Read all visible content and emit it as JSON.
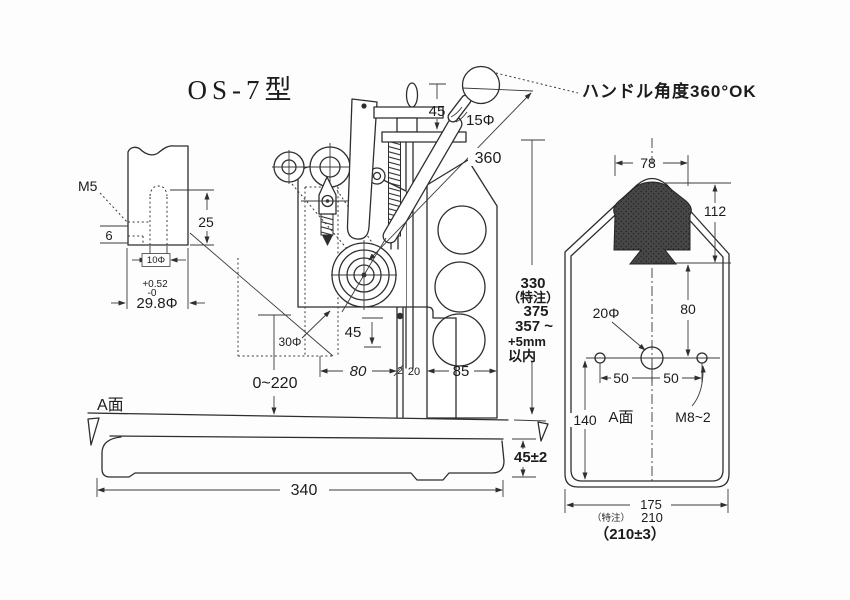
{
  "drawing": {
    "title": "OS-7型",
    "handle_note": "ハンドル角度360°OK",
    "detail_view": {
      "thread": "M5",
      "step": "6",
      "depth": "25",
      "hole_dia": "10Φ",
      "tol_plus": "+0.52",
      "tol_minus": "-0",
      "shank_dia": "29.8Φ"
    },
    "front_view": {
      "cap_gap": "45",
      "ball_dia": "15Φ",
      "lever_length": "360",
      "ram_dia": "30Φ",
      "ram_gap": "45",
      "work_range": "0~220",
      "dim_80": "80",
      "dim_2": "2",
      "dim_20": "20",
      "dim_85": "85",
      "height_330": "330",
      "height_note": "（特注）",
      "height_375": "375",
      "height_357": "357 ~",
      "height_plus5": "+5mm",
      "height_within": "以内",
      "base_surface": "A面",
      "base_height": "45±2",
      "base_length": "340"
    },
    "side_view": {
      "top_width": "78",
      "head_height": "112",
      "hole_offset": "80",
      "center_hole": "20Φ",
      "pitch_left": "50",
      "pitch_right": "50",
      "base_depth": "140",
      "surface": "A面",
      "bolts": "M8~2",
      "width_175": "175",
      "width_note": "（特注）",
      "width_210": "210",
      "width_tol": "（210±3）"
    }
  }
}
